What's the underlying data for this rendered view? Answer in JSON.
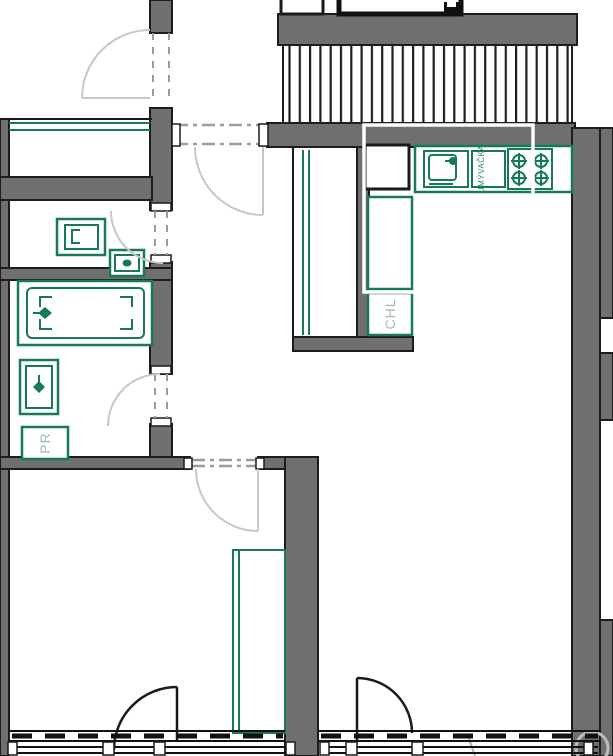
{
  "labels": {
    "fridge": "CHL",
    "washing_machine": "PR",
    "dishwasher": "UMÝVAČKA"
  },
  "colors": {
    "background": "#ffffff",
    "wall_fill": "#6f6f6f",
    "wall_outline": "#1d1d1d",
    "fixture_green": "#17795c",
    "muted_label": "#a4bcb3",
    "door_arc_gray": "#c7c7c7",
    "balcony_door_black": "#1a1a1a",
    "selection_overlay": "#ffffff"
  }
}
